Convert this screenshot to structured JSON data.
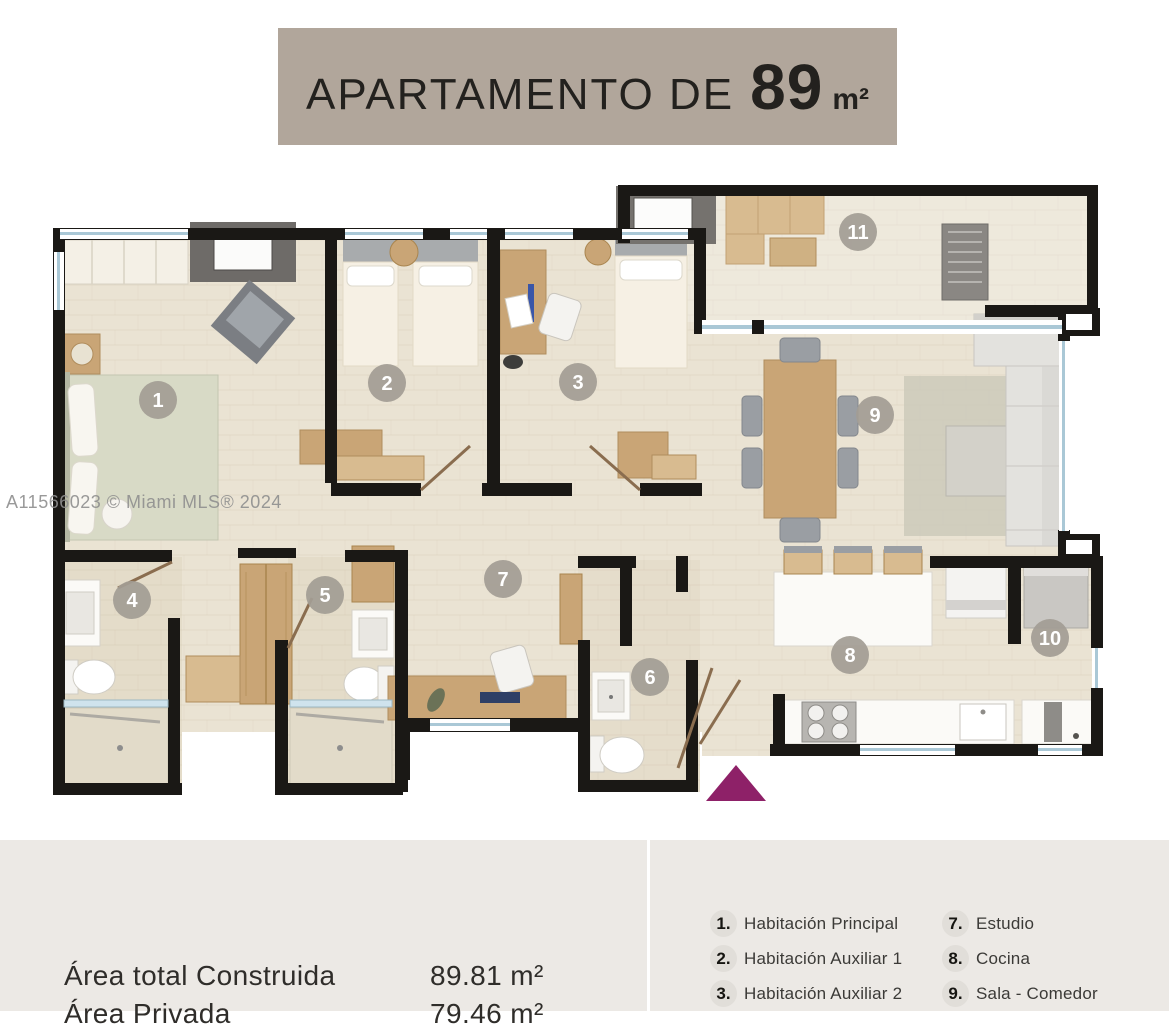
{
  "title": {
    "prefix": "APARTAMENTO DE",
    "size": "89",
    "unit": "m²"
  },
  "watermark": "A11566023 © Miami MLS® 2024",
  "plan": {
    "entrance_color": "#8e2168",
    "wall_color": "#1a1815",
    "floor_color": "#eae3d3",
    "badge_color": "#a39d95",
    "badges": [
      {
        "n": "1",
        "x": 158,
        "y": 400
      },
      {
        "n": "2",
        "x": 387,
        "y": 383
      },
      {
        "n": "3",
        "x": 578,
        "y": 382
      },
      {
        "n": "4",
        "x": 132,
        "y": 600
      },
      {
        "n": "5",
        "x": 325,
        "y": 595
      },
      {
        "n": "6",
        "x": 650,
        "y": 677
      },
      {
        "n": "7",
        "x": 503,
        "y": 579
      },
      {
        "n": "8",
        "x": 850,
        "y": 655
      },
      {
        "n": "9",
        "x": 875,
        "y": 415
      },
      {
        "n": "10",
        "x": 1050,
        "y": 638
      },
      {
        "n": "11",
        "x": 858,
        "y": 232
      }
    ]
  },
  "areas": {
    "rows": [
      {
        "label": "Área total Construida",
        "value": "89.81 m²"
      },
      {
        "label": "Área Privada",
        "value": "79.46 m²"
      }
    ]
  },
  "legend": {
    "column1": [
      {
        "num": "1.",
        "label": "Habitación Principal"
      },
      {
        "num": "2.",
        "label": "Habitación Auxiliar 1"
      },
      {
        "num": "3.",
        "label": "Habitación Auxiliar 2"
      }
    ],
    "column2": [
      {
        "num": "7.",
        "label": "Estudio"
      },
      {
        "num": "8.",
        "label": "Cocina"
      },
      {
        "num": "9.",
        "label": "Sala - Comedor"
      }
    ]
  }
}
